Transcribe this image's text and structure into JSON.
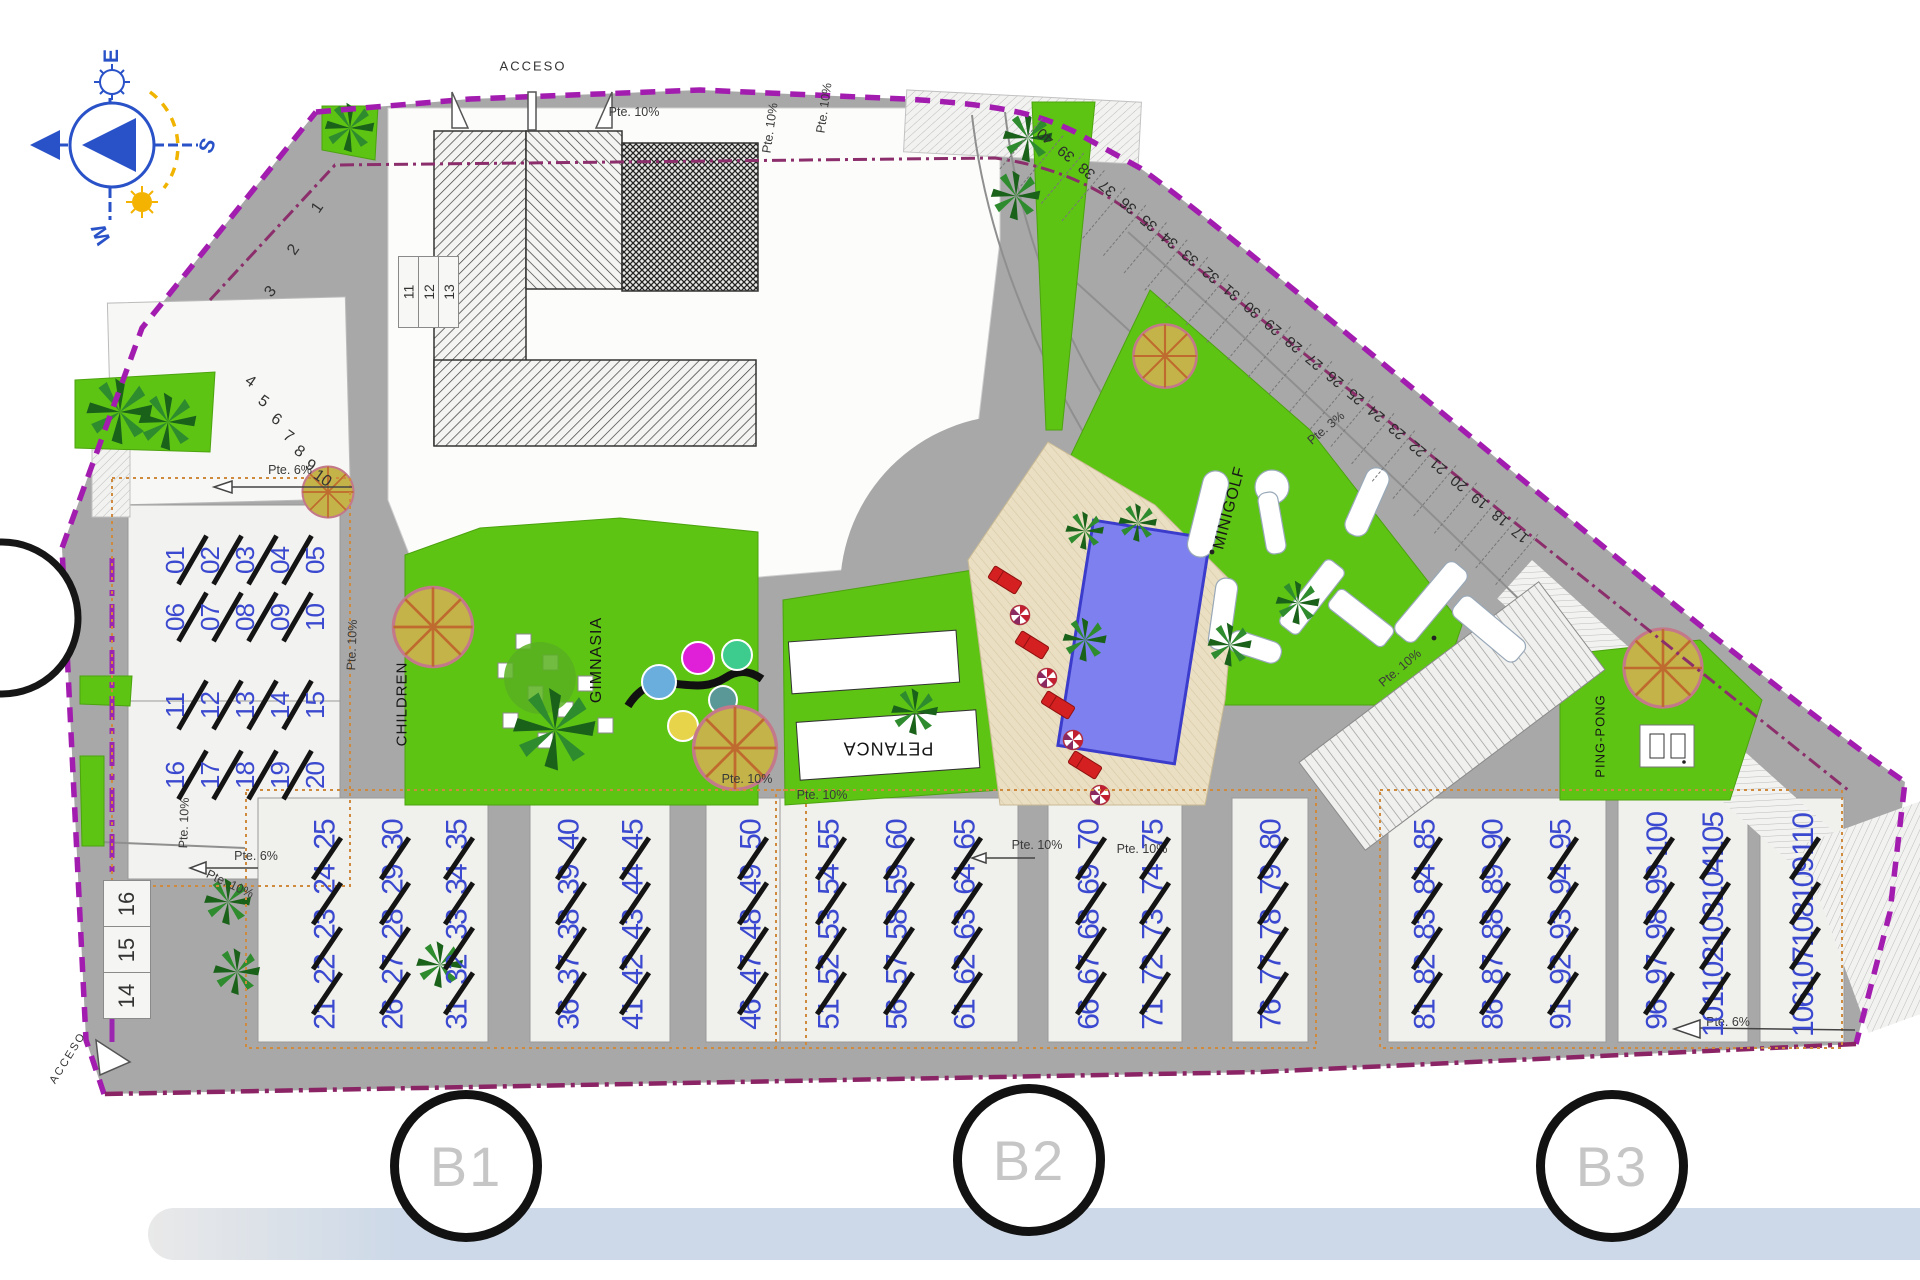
{
  "compass": {
    "east": "E",
    "south": "S",
    "west": "W"
  },
  "access": {
    "top": "ACCESO",
    "bottom": "ACCESO"
  },
  "amenities": {
    "children": "CHILDREN",
    "gym": "GIMNASIA",
    "petanca": "PETANCA",
    "minigolf": "MINIGOLF",
    "pingpong": "PING-PONG"
  },
  "sections": [
    "B1",
    "B2",
    "B3"
  ],
  "slopes": [
    "Pte. 10%",
    "Pte. 10%",
    "Pte. 10%",
    "Pte. 6%",
    "Pte. 10%",
    "Pte. 10%",
    "Pte. 10%",
    "Pte. 10%",
    "Pte. 10%",
    "Pte. 10%",
    "Pte. 10%",
    "Pte. 10%",
    "Pte. 3%",
    "Pte. 6%",
    "Pte. 6%"
  ],
  "parking": {
    "left_fan": [
      "1",
      "2",
      "3",
      "4",
      "5",
      "6",
      "7",
      "8",
      "9",
      "10"
    ],
    "left_box": [
      "11",
      "12",
      "13"
    ],
    "left_column": [
      "16",
      "15",
      "14"
    ],
    "right_band": [
      "40",
      "39",
      "38",
      "37",
      "36",
      "35",
      "34",
      "33",
      "32",
      "31",
      "30",
      "29",
      "28",
      "27",
      "26",
      "25",
      "24",
      "23",
      "22",
      "21",
      "20",
      "19",
      "18",
      "17"
    ]
  },
  "units": {
    "left_rows": [
      [
        "01",
        "02",
        "03",
        "04",
        "05"
      ],
      [
        "06",
        "07",
        "08",
        "09",
        "10"
      ],
      [
        "11",
        "12",
        "13",
        "14",
        "15"
      ],
      [
        "16",
        "17",
        "18",
        "19",
        "20"
      ]
    ],
    "b1_columns": [
      [
        "21",
        "22",
        "23",
        "24",
        "25"
      ],
      [
        "26",
        "27",
        "28",
        "29",
        "30"
      ],
      [
        "31",
        "32",
        "33",
        "34",
        "35"
      ],
      [
        "36",
        "37",
        "38",
        "39",
        "40"
      ],
      [
        "41",
        "42",
        "43",
        "44",
        "45"
      ],
      [
        "46",
        "47",
        "48",
        "49",
        "50"
      ]
    ],
    "b2_columns": [
      [
        "51",
        "52",
        "53",
        "54",
        "55"
      ],
      [
        "56",
        "57",
        "58",
        "59",
        "60"
      ],
      [
        "61",
        "62",
        "63",
        "64",
        "65"
      ],
      [
        "66",
        "67",
        "68",
        "69",
        "70"
      ],
      [
        "71",
        "72",
        "73",
        "74",
        "75"
      ],
      [
        "76",
        "77",
        "78",
        "79",
        "80"
      ]
    ],
    "b3_columns": [
      [
        "81",
        "82",
        "83",
        "84",
        "85"
      ],
      [
        "86",
        "87",
        "88",
        "89",
        "90"
      ],
      [
        "91",
        "92",
        "93",
        "94",
        "95"
      ],
      [
        "96",
        "97",
        "98",
        "99",
        "100"
      ],
      [
        "101",
        "102",
        "103",
        "104",
        "105"
      ],
      [
        "106",
        "107",
        "108",
        "109",
        "110"
      ]
    ]
  }
}
